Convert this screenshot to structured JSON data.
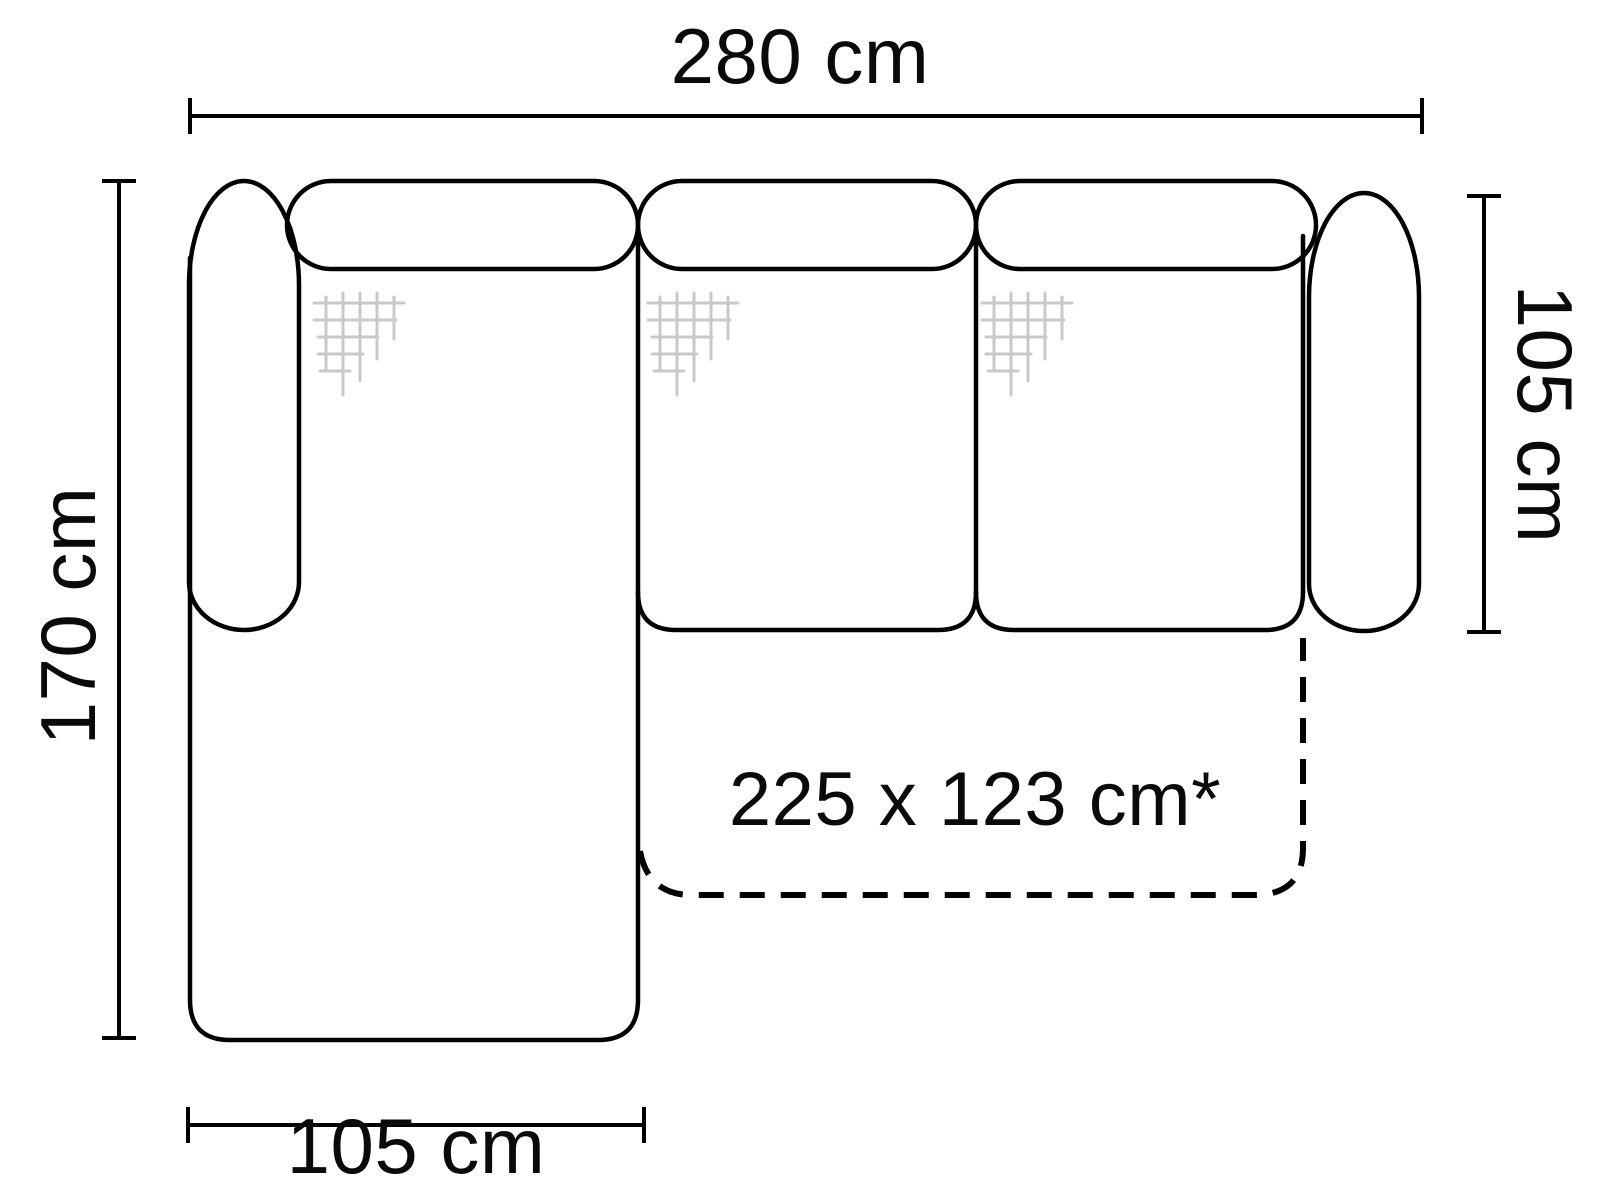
{
  "diagram": {
    "type": "sofa-top-view-dimension-drawing",
    "background_color": "#ffffff",
    "line_color": "#000000",
    "texture_color": "#c9c9c9",
    "text_color": "#0a0a0a",
    "labels": {
      "total_width": "280 cm",
      "chaise_depth": "170 cm",
      "sofa_depth": "105 cm",
      "chaise_width": "105 cm",
      "sleeping_area": "225 x 123 cm*"
    },
    "texture_icon": "fabric-crosshatch"
  }
}
